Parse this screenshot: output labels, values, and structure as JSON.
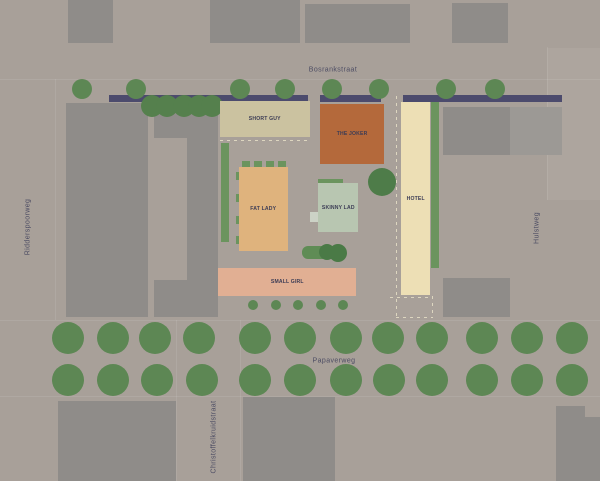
{
  "map": {
    "streets": {
      "top": "Bosrankstraat",
      "left": "Ridderspoorweg",
      "right": "Hulstweg",
      "bottom": "Papaverweg",
      "bottom_cross": "Christoffelkruidstraat"
    },
    "colors": {
      "background": "#a8a099",
      "block_light": "#ada59e",
      "building_context": "#8f8c89",
      "street_bar": "#4c4b6d",
      "tree": "#5d8754",
      "tree_dark": "#4e7c49",
      "hedge": "#6b945e",
      "label": "#3c3c55",
      "street_label": "#4c4c63",
      "dashed": "#ddd6c0",
      "curb": "rgba(255,255,255,0.09)"
    },
    "buildings": [
      {
        "id": "short-guy",
        "label": "SHORT GUY",
        "color": "#cbc2a0",
        "x": 220,
        "y": 101,
        "w": 90,
        "h": 36
      },
      {
        "id": "the-joker",
        "label": "THE JOKER",
        "color": "#b4693b",
        "x": 320,
        "y": 104,
        "w": 64,
        "h": 60
      },
      {
        "id": "fat-lady",
        "label": "FAT LADY",
        "color": "#dfb37d",
        "x": 239,
        "y": 167,
        "w": 49,
        "h": 84
      },
      {
        "id": "skinny-lad",
        "label": "SKINNY LAD",
        "color": "#b8c6b1",
        "x": 318,
        "y": 183,
        "w": 40,
        "h": 49
      },
      {
        "id": "hotel",
        "label": "HOTEL",
        "color": "#eddfb5",
        "x": 401,
        "y": 102,
        "w": 29,
        "h": 193
      },
      {
        "id": "small-girl",
        "label": "SMALL GIRL",
        "color": "#e1af93",
        "x": 218,
        "y": 268,
        "w": 138,
        "h": 28
      }
    ],
    "light_blocks": [
      {
        "x": 547,
        "y": 48,
        "w": 53,
        "h": 152
      }
    ],
    "context_buildings": [
      {
        "x": 68,
        "y": 0,
        "w": 45,
        "h": 43
      },
      {
        "x": 210,
        "y": 0,
        "w": 90,
        "h": 43
      },
      {
        "x": 305,
        "y": 4,
        "w": 105,
        "h": 39
      },
      {
        "x": 452,
        "y": 3,
        "w": 56,
        "h": 40
      },
      {
        "x": 66,
        "y": 103,
        "w": 82,
        "h": 214
      },
      {
        "x": 154,
        "y": 103,
        "w": 64,
        "h": 214
      },
      {
        "x": 443,
        "y": 107,
        "w": 67,
        "h": 48
      },
      {
        "x": 510,
        "y": 107,
        "w": 52,
        "h": 48,
        "color": "#9c9995"
      },
      {
        "x": 443,
        "y": 278,
        "w": 67,
        "h": 39
      },
      {
        "x": 58,
        "y": 401,
        "w": 118,
        "h": 80
      },
      {
        "x": 243,
        "y": 397,
        "w": 92,
        "h": 84
      },
      {
        "x": 556,
        "y": 406,
        "w": 44,
        "h": 75
      }
    ],
    "background_patches": [
      {
        "x": 154,
        "y": 138,
        "w": 33,
        "h": 142
      },
      {
        "x": 585,
        "y": 406,
        "w": 15,
        "h": 11
      }
    ],
    "street_bars": [
      {
        "x": 109,
        "y": 95,
        "w": 199,
        "h": 7
      },
      {
        "x": 320,
        "y": 95,
        "w": 61,
        "h": 7
      },
      {
        "x": 403,
        "y": 95,
        "w": 159,
        "h": 7
      }
    ],
    "hedges": [
      {
        "x": 221,
        "y": 143,
        "w": 8,
        "h": 99
      },
      {
        "x": 431,
        "y": 102,
        "w": 8,
        "h": 166
      },
      {
        "x": 318,
        "y": 179,
        "w": 25,
        "h": 6
      },
      {
        "x": 242,
        "y": 161,
        "w": 8,
        "h": 6
      },
      {
        "x": 254,
        "y": 161,
        "w": 8,
        "h": 6
      },
      {
        "x": 266,
        "y": 161,
        "w": 8,
        "h": 6
      },
      {
        "x": 278,
        "y": 161,
        "w": 8,
        "h": 6
      },
      {
        "x": 236,
        "y": 172,
        "w": 3,
        "h": 8
      },
      {
        "x": 236,
        "y": 194,
        "w": 3,
        "h": 8
      },
      {
        "x": 236,
        "y": 216,
        "w": 3,
        "h": 8
      },
      {
        "x": 236,
        "y": 236,
        "w": 3,
        "h": 8
      },
      {
        "x": 310,
        "y": 212,
        "w": 9,
        "h": 10,
        "color": "#ccd2c6"
      }
    ],
    "green_pill": {
      "x": 302,
      "y": 246,
      "w": 41,
      "h": 13,
      "color": "#5f8c55",
      "circle_color": "#4a7a46",
      "circles": [
        {
          "cx": 327,
          "cy": 252,
          "r": 8
        },
        {
          "cx": 338,
          "cy": 253,
          "r": 9
        }
      ]
    },
    "tree_rows": [
      {
        "name": "bosrankstraat-trees",
        "y": 89,
        "r": 10,
        "xs": [
          82,
          136,
          240,
          285,
          332,
          379,
          446,
          495
        ]
      },
      {
        "name": "tree-cluster",
        "y": 106,
        "r": 11,
        "color": "#55804d",
        "xs": [
          152,
          167,
          184,
          199,
          212
        ]
      },
      {
        "name": "courtyard-tree",
        "y": 182,
        "r": 14,
        "color": "#4e7c49",
        "xs": [
          382
        ]
      },
      {
        "name": "courtyard-small-trees",
        "y": 305,
        "r": 5,
        "xs": [
          253,
          276,
          298,
          321,
          343
        ]
      },
      {
        "name": "papaverweg-trees-north",
        "y": 338,
        "r": 16,
        "xs": [
          68,
          113,
          155,
          199,
          255,
          300,
          346,
          388,
          432,
          482,
          527,
          572
        ]
      },
      {
        "name": "papaverweg-trees-south",
        "y": 380,
        "r": 16,
        "xs": [
          68,
          113,
          157,
          202,
          255,
          300,
          346,
          389,
          432,
          482,
          527,
          572
        ]
      }
    ],
    "dashed_lines": [
      {
        "o": "v",
        "x": 396,
        "y": 96,
        "h": 221
      },
      {
        "o": "h",
        "x": 220,
        "y": 140,
        "w": 90
      },
      {
        "o": "h",
        "x": 390,
        "y": 297,
        "w": 42
      },
      {
        "o": "v",
        "x": 432,
        "y": 296,
        "h": 21
      },
      {
        "o": "h",
        "x": 396,
        "y": 317,
        "w": 37
      }
    ],
    "curb_lines": [
      {
        "x": 0,
        "y": 79,
        "w": 600,
        "h": 1
      },
      {
        "x": 0,
        "y": 320,
        "w": 600,
        "h": 1
      },
      {
        "x": 0,
        "y": 396,
        "w": 600,
        "h": 1
      },
      {
        "x": 55,
        "y": 79,
        "w": 1,
        "h": 241
      },
      {
        "x": 547,
        "y": 47,
        "w": 1,
        "h": 153
      },
      {
        "x": 176,
        "y": 320,
        "w": 1,
        "h": 161
      },
      {
        "x": 240,
        "y": 320,
        "w": 1,
        "h": 161
      }
    ]
  }
}
